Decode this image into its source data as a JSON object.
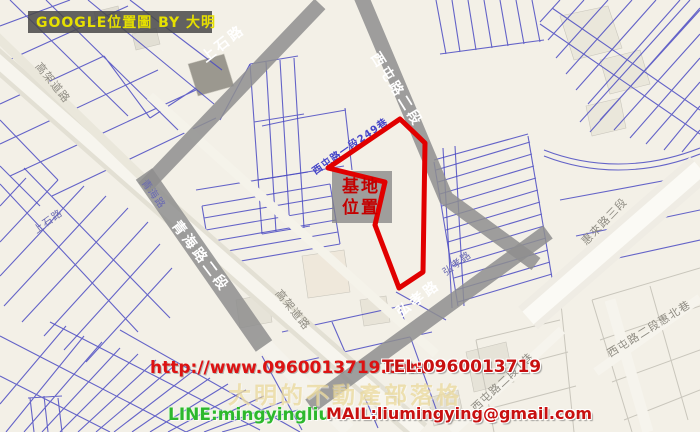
{
  "banner": {
    "title": "GOOGLE位置圖 BY 大明"
  },
  "site_marker": {
    "line1": "基地",
    "line2": "位置"
  },
  "roads": {
    "shangshi": "上石路",
    "xitun_sec2": "西屯路二段",
    "qinghai_sec2": "青海路二段",
    "qinghai": "青海路",
    "hongxiao": "弘孝路",
    "huilai_sec3": "惠來路三段",
    "xitun2_huibei_lane": "西屯路二段惠北巷",
    "xitun2_lane1": "西屯路二段1巷",
    "xitun1_lane249": "西屯路一段249巷",
    "elevated": "高架道路"
  },
  "watermarks": {
    "url": "http://www.0960013719.com",
    "tel": "TEL:0960013719",
    "blog": "大明的不動產部落格",
    "line": "LINE:mingyingliu",
    "mail": "MAIL:liumingying@gmail.com"
  },
  "colors": {
    "map_background": "#f3f0e7",
    "parcel_line_blue": "#4a4ac2",
    "road_band_gray": "#8e8e8e",
    "site_outline_red": "#e10000",
    "site_label_red": "#c40000",
    "banner_text_yellow": "#e6e000",
    "watermark_red": "#c81010",
    "watermark_green": "#2db82d",
    "watermark_gold": "#e8d68c"
  }
}
